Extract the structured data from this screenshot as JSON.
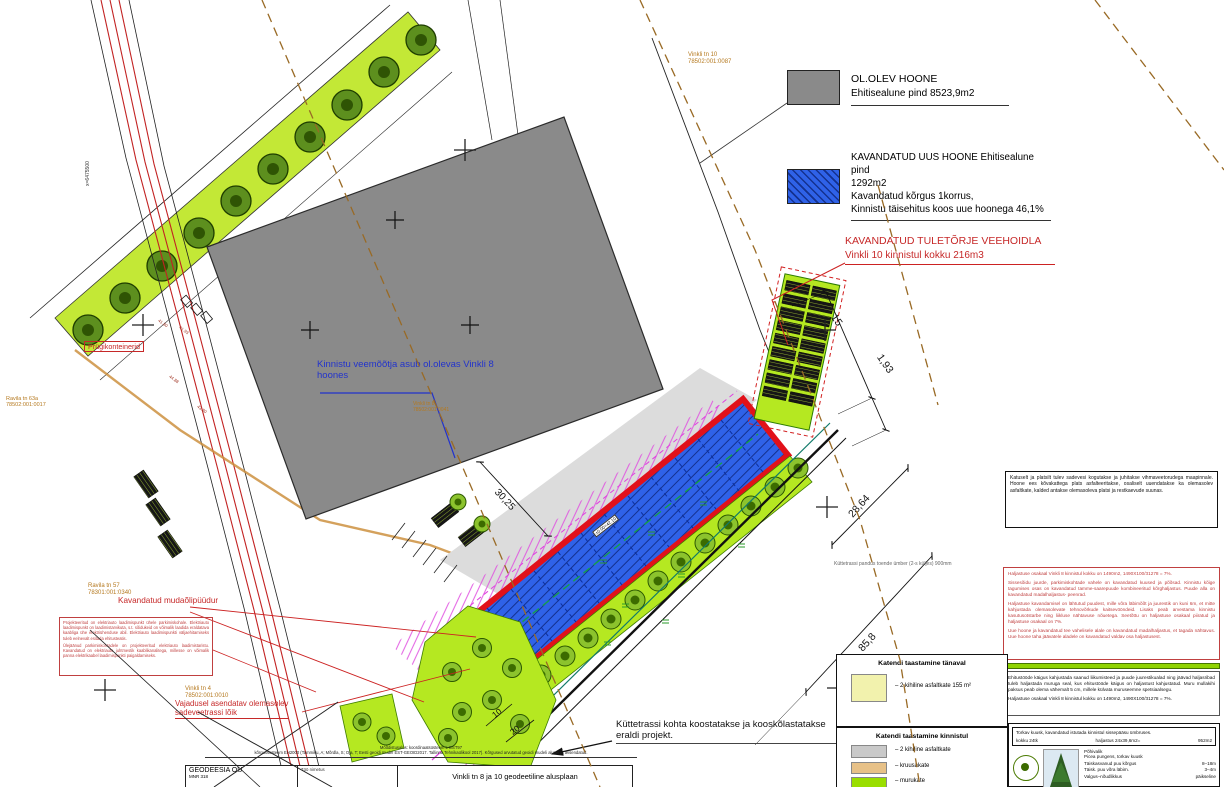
{
  "colors": {
    "existing_building": "#8a8a8a",
    "planned_building": "#2a5be0",
    "planned_outline": "#e1111a",
    "grass": "#b5e821",
    "annotation_red": "#c62828",
    "annotation_orange": "#b5791f",
    "annotation_blue": "#2233cc"
  },
  "legend_top": {
    "existing": {
      "title": "OL.OLEV HOONE",
      "area": "Ehitisealune pind 8523,9m2"
    },
    "planned": {
      "line1": "KAVANDATUD UUS HOONE Ehitisealune pind",
      "line2": "1292m2",
      "line3": "Kavandatud kõrgus 1korrus,",
      "line4": "Kinnistu täisehitus koos uue hoonega 46,1%"
    },
    "fire": {
      "line1": "KAVANDATUD TULETÕRJE VEEHOIDLA",
      "line2": "Vinkli 10 kinnistul  kokku 216m3"
    }
  },
  "annotations": {
    "water_meter": "Kinnistu veemõõtja asub ol.olevas Vinkli 8 hoones",
    "waste": "Prügikonteinerid",
    "oil_trap": "Kavandatud mudaõlipüüdur",
    "replace_line1": "Vajadusel asendatav olemasolev",
    "replace_line2": "sadeveetrassi lõik",
    "heating_line1": "Küttetrassi kohta koostatakse ja kooskõlastatakse",
    "heating_line2": "eraldi projekt.",
    "heating_small": "Küttetrassi pandus toende ümber (2-s küljes) 900mm",
    "level": "±0.00=42.10",
    "coord_x": "x=6475500",
    "ev_p1": "Projekteeritud on elektriauto laadimispunkt ühele parkimiskohale. Elektriauto laadimispunkt on laadimistarvikuta, s.t. sõidukeid on võimalik laadida eraldatava kaabliga ühe elektriühenduse abil. Elektriauto laadimispunkti väljaehitamiseks tuleb eelnevalt esitada ehitusteatis.",
    "ev_p2": "Ülejäänud parkimiskohtadele on projekteeritud elektriauto laadimistaristu. Kavandatud on elektriauto juhtmestik kaablikanalitega, millesse on võimalik panna elektrikaabel laadimispunkti paigaldamiseks."
  },
  "cadastral": [
    {
      "name": "Ravila tn 63a",
      "code": "78502:001:0017"
    },
    {
      "name": "Ravila tn 57",
      "code": "78301:001:0340"
    },
    {
      "name": "Vinkli tn 4",
      "code": "78502:001:0010"
    },
    {
      "name": "Vinkli tn 8",
      "code": "78502:001:0041"
    },
    {
      "name": "Vinkli tn 10",
      "code": "78502:001:0087"
    }
  ],
  "dims": {
    "d15": "15",
    "d193": "1,93",
    "d2864": "28,64",
    "d858": "85,8",
    "d3025": "30,25",
    "d10": "10",
    "d20": "20"
  },
  "elevations": [
    "41.80",
    "41.93",
    "44.88",
    "43.80"
  ],
  "legend_bottom": {
    "street_title": "Katendi taastamine tänaval",
    "street_item": "– 2 kihiline asfaltkate 155 m²",
    "plot_title": "Katendi taastamine kinnistul",
    "plot_items": [
      "– 2 kihiline asfaltkate",
      "– kruusakate",
      "– murukate"
    ]
  },
  "right_panel": {
    "drainage": "Katuselt ja platsilt tulev sadevesi kogutakse ja juhitakse vihmaveetorudega maapinnale. Hoone ees kõvakattega plats asfalteeritakse, osaliselt uuendatakse ka olemasolev asfaltkate, kalded antakse olemasoleva platsi ja restkaevude suunas.",
    "landscape": {
      "p1": "Haljastuse osakaal Vinkli 8 kinnistul kokku on 1490m2,  1490X100/31278 = 7%.",
      "p2": "Sissesõidu juurde, parkimiskohtade vahele on kavandatud kuused ja põõsad. Kinnistu kõige tagumises osas on kavandatud tamme-saarepuude kombineeritud kõrghaljastus. Puude alla on kavandatud madalhaljastus- peenrad.",
      "p3": "Haljastuse kavandamisel on lähtutud puudest, mille võra läbimõõt ja juurestik on kuni 6m, et mitte kahjustada olemasolevate tehnovõrkude kaitsevööndeid. Lisaks peab arvestama kinnistu kasutusotstarbe ning liikluse nähtavuse nõuetega. Seetõttu on haljastuse osakaal piiratud ja haljastuse osakaal on 7%.",
      "p4": "Uue hoone ja kavandatud tee vahelisele alale on kavandatud madalhaljastus, et tagada nähtavus. Uue hoone taha jäävatele aladele on kavandatud valdav osa haljastusest."
    },
    "restore": {
      "p1": "Ehitustööde käigus kahjustada saanud liikumisteed ja puude juurestikualad ning jäävad haljasribad tuleb haljastada muruga seal, kus ehitustööde käigus on haljastust kahjustatud. Muru mullakihi paksus peab olema vähemalt 5 cm, millele külvata muruseemne spetsiaalsegu.",
      "p2": "Haljastuse osakaal Vinkli 8 kinnistul kokku on 1490m2,  1490X100/31278 = 7%."
    },
    "tree": {
      "header": "Torkav kuusk, kavandatud istutada kinnistul sissepääsu ümbruses.",
      "count": "kokku 24tk",
      "formula": "haljastus 24x39,6m2=",
      "area": "952m2",
      "spec_title": "Põhivalik",
      "rows": [
        {
          "label": "Picea pungens, torkav kuusk",
          "value": ""
        },
        {
          "label": "Täiskasvanud puu kõrgus",
          "value": "8–18m"
        },
        {
          "label": "Täisk. puu võra läbim.",
          "value": "3–4m"
        },
        {
          "label": "Valgus–nõudlikkus",
          "value": "päikseline"
        }
      ]
    }
  },
  "titleblock": {
    "micro1": "Mõõdistusalus: koordinaatsüsteem L-EST97",
    "micro2": "kõrgussüsteem EH2000 (Tammiku, A; Mõrdla, S; Oja, T; Eesti geoidi mudel EST-GEOID2017. Tallinna Tehnikaülikool 2017). Kõrgused arvutatud geoidi mudeli alusel ja teisendatud.",
    "firm": "GEODEESIA OÜ",
    "reg": "MNR 318",
    "label": "Töö nimetus",
    "title": "Vinkli tn 8 ja 10 geodeetiline alusplaan"
  }
}
